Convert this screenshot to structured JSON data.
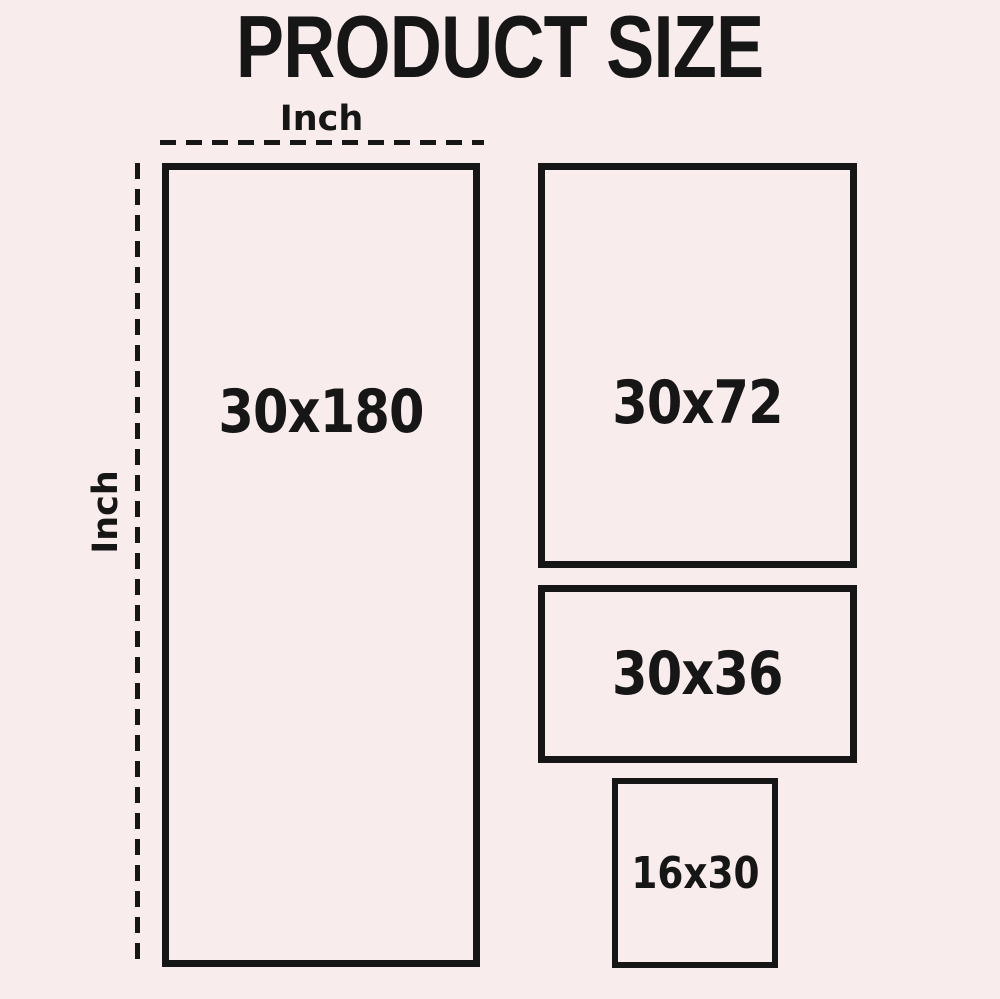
{
  "title": "PRODUCT SIZE",
  "dimension_labels": {
    "top": "Inch",
    "left": "Inch"
  },
  "colors": {
    "background": "#f8ecec",
    "line": "#161616",
    "text": "#161616"
  },
  "sizes": [
    {
      "label": "30x180"
    },
    {
      "label": "30x72"
    },
    {
      "label": "30x36"
    },
    {
      "label": "16x30"
    }
  ]
}
